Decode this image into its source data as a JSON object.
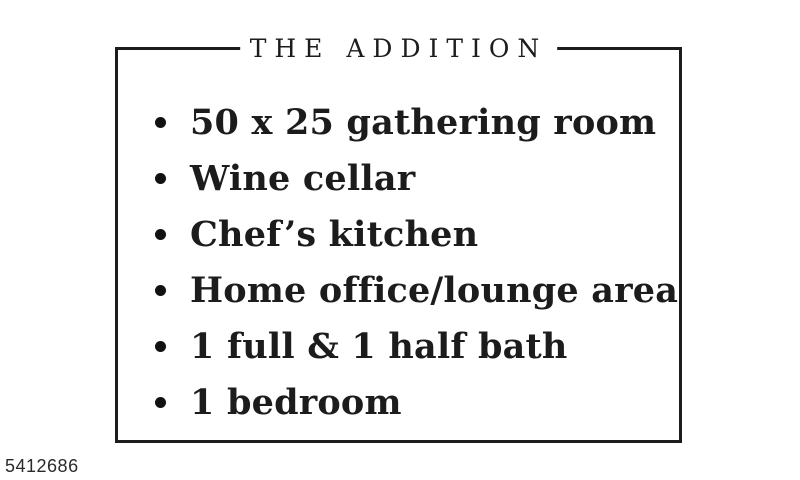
{
  "page": {
    "background_color": "#ffffff",
    "ink_color": "#1c1c1c"
  },
  "card": {
    "title": "THE ADDITION",
    "items": [
      "50 x 25 gathering room",
      "Wine cellar",
      "Chef’s kitchen",
      "Home office/lounge area",
      "1 full & 1 half bath",
      "1 bedroom"
    ]
  },
  "footer": {
    "listing_id": "5412686"
  }
}
